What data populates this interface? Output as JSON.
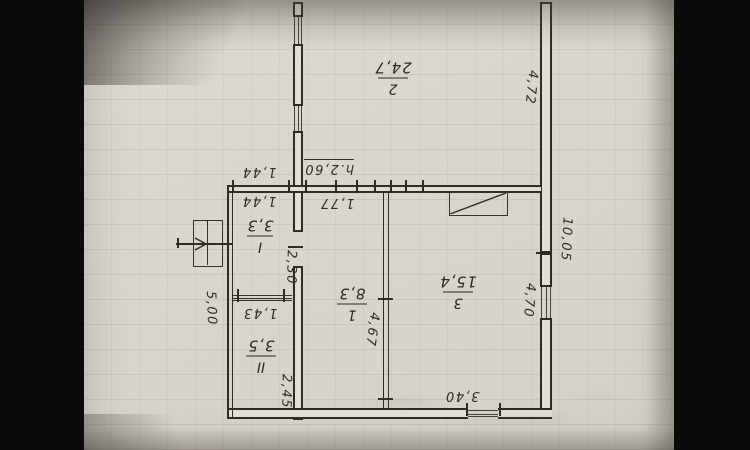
{
  "plan_title": "single-storey house floor plan (photographed upside down)",
  "colors": {
    "background": "#0a0a0a",
    "paper": "#d9d5cd",
    "ink": "#2f2c27"
  },
  "rooms": [
    {
      "number": "2",
      "area": "24,7"
    },
    {
      "number": "1",
      "area": "8,3"
    },
    {
      "number": "3",
      "area": "15,4"
    },
    {
      "number": "I",
      "area": "3,3"
    },
    {
      "number": "II",
      "area": "3,5"
    }
  ],
  "dims": {
    "wall_right_top": "4,72",
    "wall_right_total": "10,05",
    "window_right": "4,70",
    "window_bottom": "3,40",
    "height_note": "h.2,60",
    "dim_177": "1,77",
    "dim_144_outer": "1,44",
    "dim_144_inner": "1,44",
    "door_230": "2,30",
    "wall_left_total": "5,00",
    "window_143": "1,43",
    "dim_467": "4,67",
    "dim_245": "2,45"
  },
  "symbols": {
    "stove": "stove-symbol (rectangle with diagonal)",
    "entrance": "entrance-arrow"
  }
}
